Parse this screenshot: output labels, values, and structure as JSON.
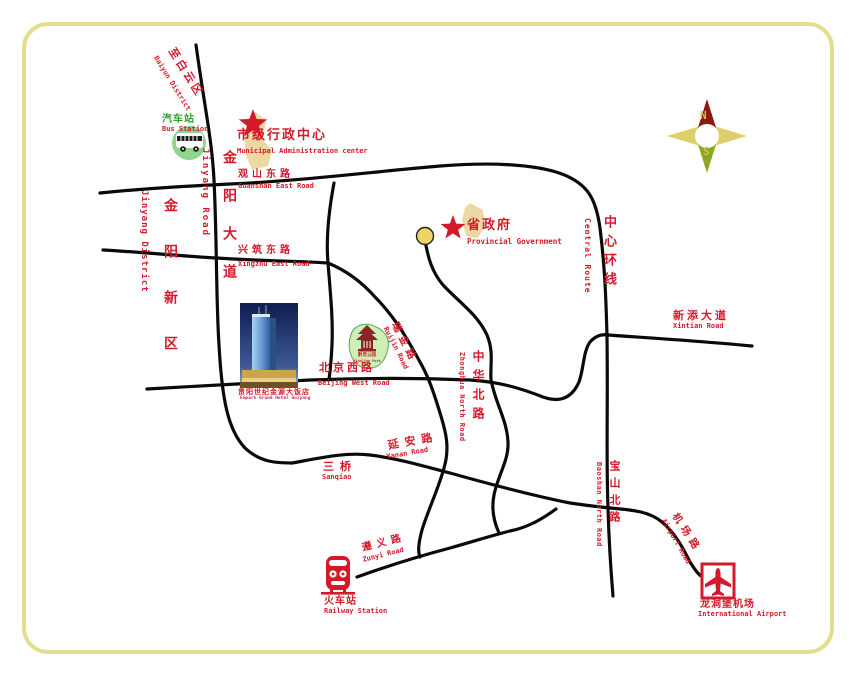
{
  "title": "Hotel location map",
  "colors": {
    "border": "#e4dd8e",
    "label_red": "#d41a2a",
    "bus_green": "#2fa12f",
    "road_black": "#0a0a0a",
    "blob_khaki": "#ecd9a2",
    "node_yellow": "#f0d566",
    "compass_north": "#8b1a10",
    "compass_south": "#8aa824",
    "compass_wing": "#ddd06a",
    "compass_letter": "#d8c04a",
    "park_green": "#cdeeb5"
  },
  "compass": {
    "north": "N",
    "south": "S"
  },
  "landmarks": {
    "bus_station": {
      "zh": "汽车站",
      "en": "Bus Station"
    },
    "municipal_center": {
      "zh": "市级行政中心",
      "en": "Municipal Administration center"
    },
    "provincial_government": {
      "zh": "省政府",
      "en": "Provincial Government"
    },
    "hotel": {
      "zh": "贵阳世纪金源大饭店",
      "en": "Empark Grand Hotel Guiyang"
    },
    "park": {
      "zh": "黔灵公园",
      "en": "Qianling Park"
    },
    "railway_station": {
      "zh": "火车站",
      "en": "Railway Station"
    },
    "airport": {
      "zh": "龙洞堡机场",
      "en": "International Airport"
    }
  },
  "roads": {
    "baiyun": {
      "zh": "至白云区",
      "en": "Baiyun District"
    },
    "jinyang_road": {
      "zh": "金阳大道",
      "en": "Jinyang Road"
    },
    "jinyang_district": {
      "zh": "金阳新区",
      "en": "Jinyang District"
    },
    "guanshan": {
      "zh": "观山东路",
      "en": "Guanshan East Road"
    },
    "xingzhu": {
      "zh": "兴筑东路",
      "en": "Xingzhu East Road"
    },
    "central_route": {
      "zh": "中心环线",
      "en": "Central Route"
    },
    "xintian": {
      "zh": "新添大道",
      "en": "Xintian Road"
    },
    "beijing_west": {
      "zh": "北京西路",
      "en": "Beijing West Road"
    },
    "ruijin": {
      "zh": "瑞金路",
      "en": "Ruijin Road"
    },
    "zhonghua": {
      "zh": "中华北路",
      "en": "Zhonghua North Road"
    },
    "yanan": {
      "zh": "延安路",
      "en": "Yanan Road"
    },
    "sanqiao": {
      "zh": "三桥",
      "en": "Sanqiao"
    },
    "baoshan": {
      "zh": "宝山北路",
      "en": "Baoshan North Road"
    },
    "zunyi": {
      "zh": "遵义路",
      "en": "Zunyi Road"
    },
    "airport_road": {
      "zh": "机场路",
      "en": "Airport Road"
    }
  }
}
